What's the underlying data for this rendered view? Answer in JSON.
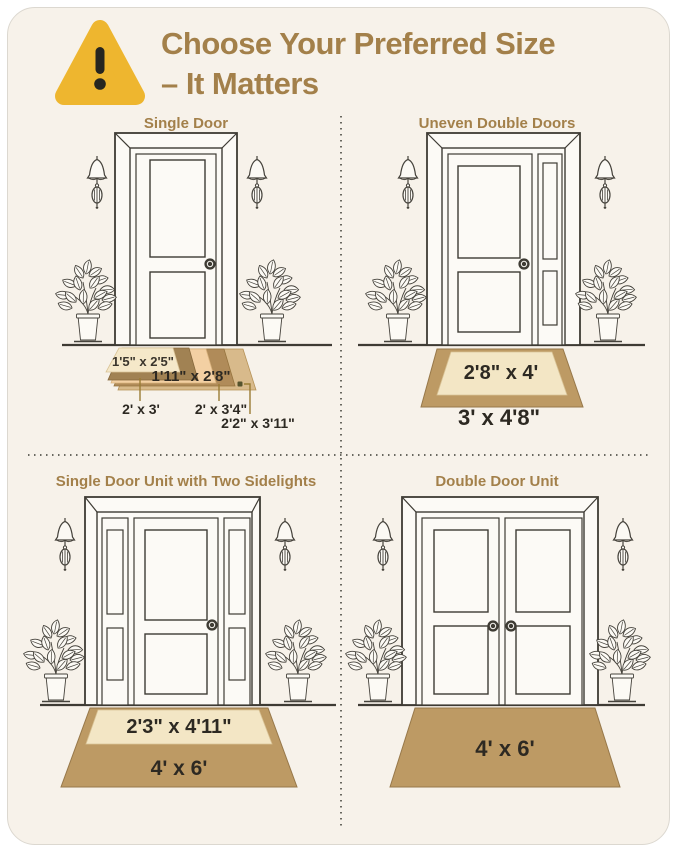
{
  "header": {
    "title_line1": "Choose Your Preferred Size",
    "title_line2": "– It Matters"
  },
  "sections": {
    "single_door": {
      "title": "Single Door",
      "sizes": [
        "1'5\" x 2'5\"",
        "1'11\" x 2'8\"",
        "2' x 3'",
        "2' x 3'4\"",
        "2'2\" x 3'11\""
      ]
    },
    "uneven_double_doors": {
      "title": "Uneven Double Doors",
      "inner_size": "2'8\" x 4'",
      "outer_size": "3' x 4'8\""
    },
    "single_door_sidelights": {
      "title": "Single Door Unit with Two Sidelights",
      "inner_size": "2'3\" x 4'11\"",
      "outer_size": "4' x 6'"
    },
    "double_door": {
      "title": "Double Door Unit",
      "size": "4' x 6'"
    }
  },
  "colors": {
    "background": "#f7f2ea",
    "accent_tan": "#a3804a",
    "warning_yellow": "#eeb62f",
    "mat_brown": "#bd9a64",
    "mat_cream": "#f3e6c5",
    "mat_dark_brown": "#a18253",
    "mat_peach": "#f3d0a3",
    "mat_light_tan": "#d8ba8b",
    "text_dark": "#2d2922",
    "line_art": "#3e3b34"
  }
}
